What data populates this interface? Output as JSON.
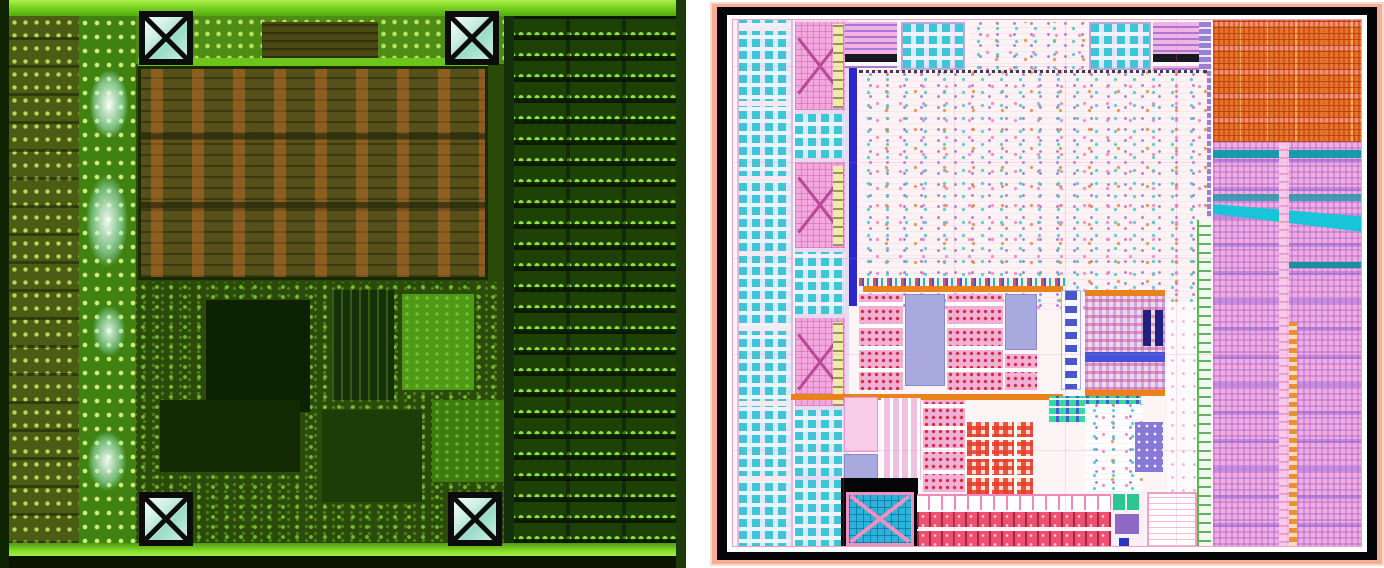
{
  "figure": {
    "panel_count": 2
  },
  "markers": {
    "die_fiducials": [
      {
        "id": "top-left",
        "symbol": "boxed-x"
      },
      {
        "id": "top-right",
        "symbol": "boxed-x"
      },
      {
        "id": "bottom-left",
        "symbol": "boxed-x"
      },
      {
        "id": "bottom-right",
        "symbol": "boxed-x"
      }
    ],
    "layout_alignment_pad": {
      "id": "bottom-left",
      "symbol": "boxed-x"
    }
  },
  "colors": {
    "die": {
      "base": "#2a4a08",
      "edge_dark": "#0e2402",
      "border_bright": "#7ad422",
      "cell_olive": "#4c5c14",
      "pad_col": "#3f8212",
      "glow_cyan": "#e8fff4",
      "mem_base": "#57501a",
      "mem_orange": "#cd6e28",
      "mem_edge": "#6cc41c",
      "logic_base": "#2c4a0a",
      "row_bg": "#1e4206",
      "row_dot": "#90e840",
      "marker_line": "#0c0c0c",
      "marker_fill": "#cdeee2"
    },
    "layout": {
      "frame_salmon": "#f7ae96",
      "frame_black": "#050508",
      "content_bg": "#fdf4f6",
      "pad_block": "#dfe8fa",
      "pad_cell": "#3ec6d6",
      "pink_pad": "#f2a8dc",
      "yellow_strip": "#f2e8ac",
      "blue_bar": "#2a28c8",
      "core_bg": "#fdf3f5",
      "orange_bar": "#e8821a",
      "lavender": "#a8aade",
      "red_cell": "#d82838",
      "green_table_bg": "#4060d8",
      "green_table_cell": "#38d8a0",
      "purple_strip": "#9a80d0",
      "right_orange": "#e07828",
      "right_pink": "#eeaede",
      "teal_band": "#1a9aa8",
      "black_zone": "#060608",
      "align_pad_cyan": "#2ab4dc",
      "align_pad_border": "#f090c0",
      "strip_red": "#ee5070"
    }
  }
}
